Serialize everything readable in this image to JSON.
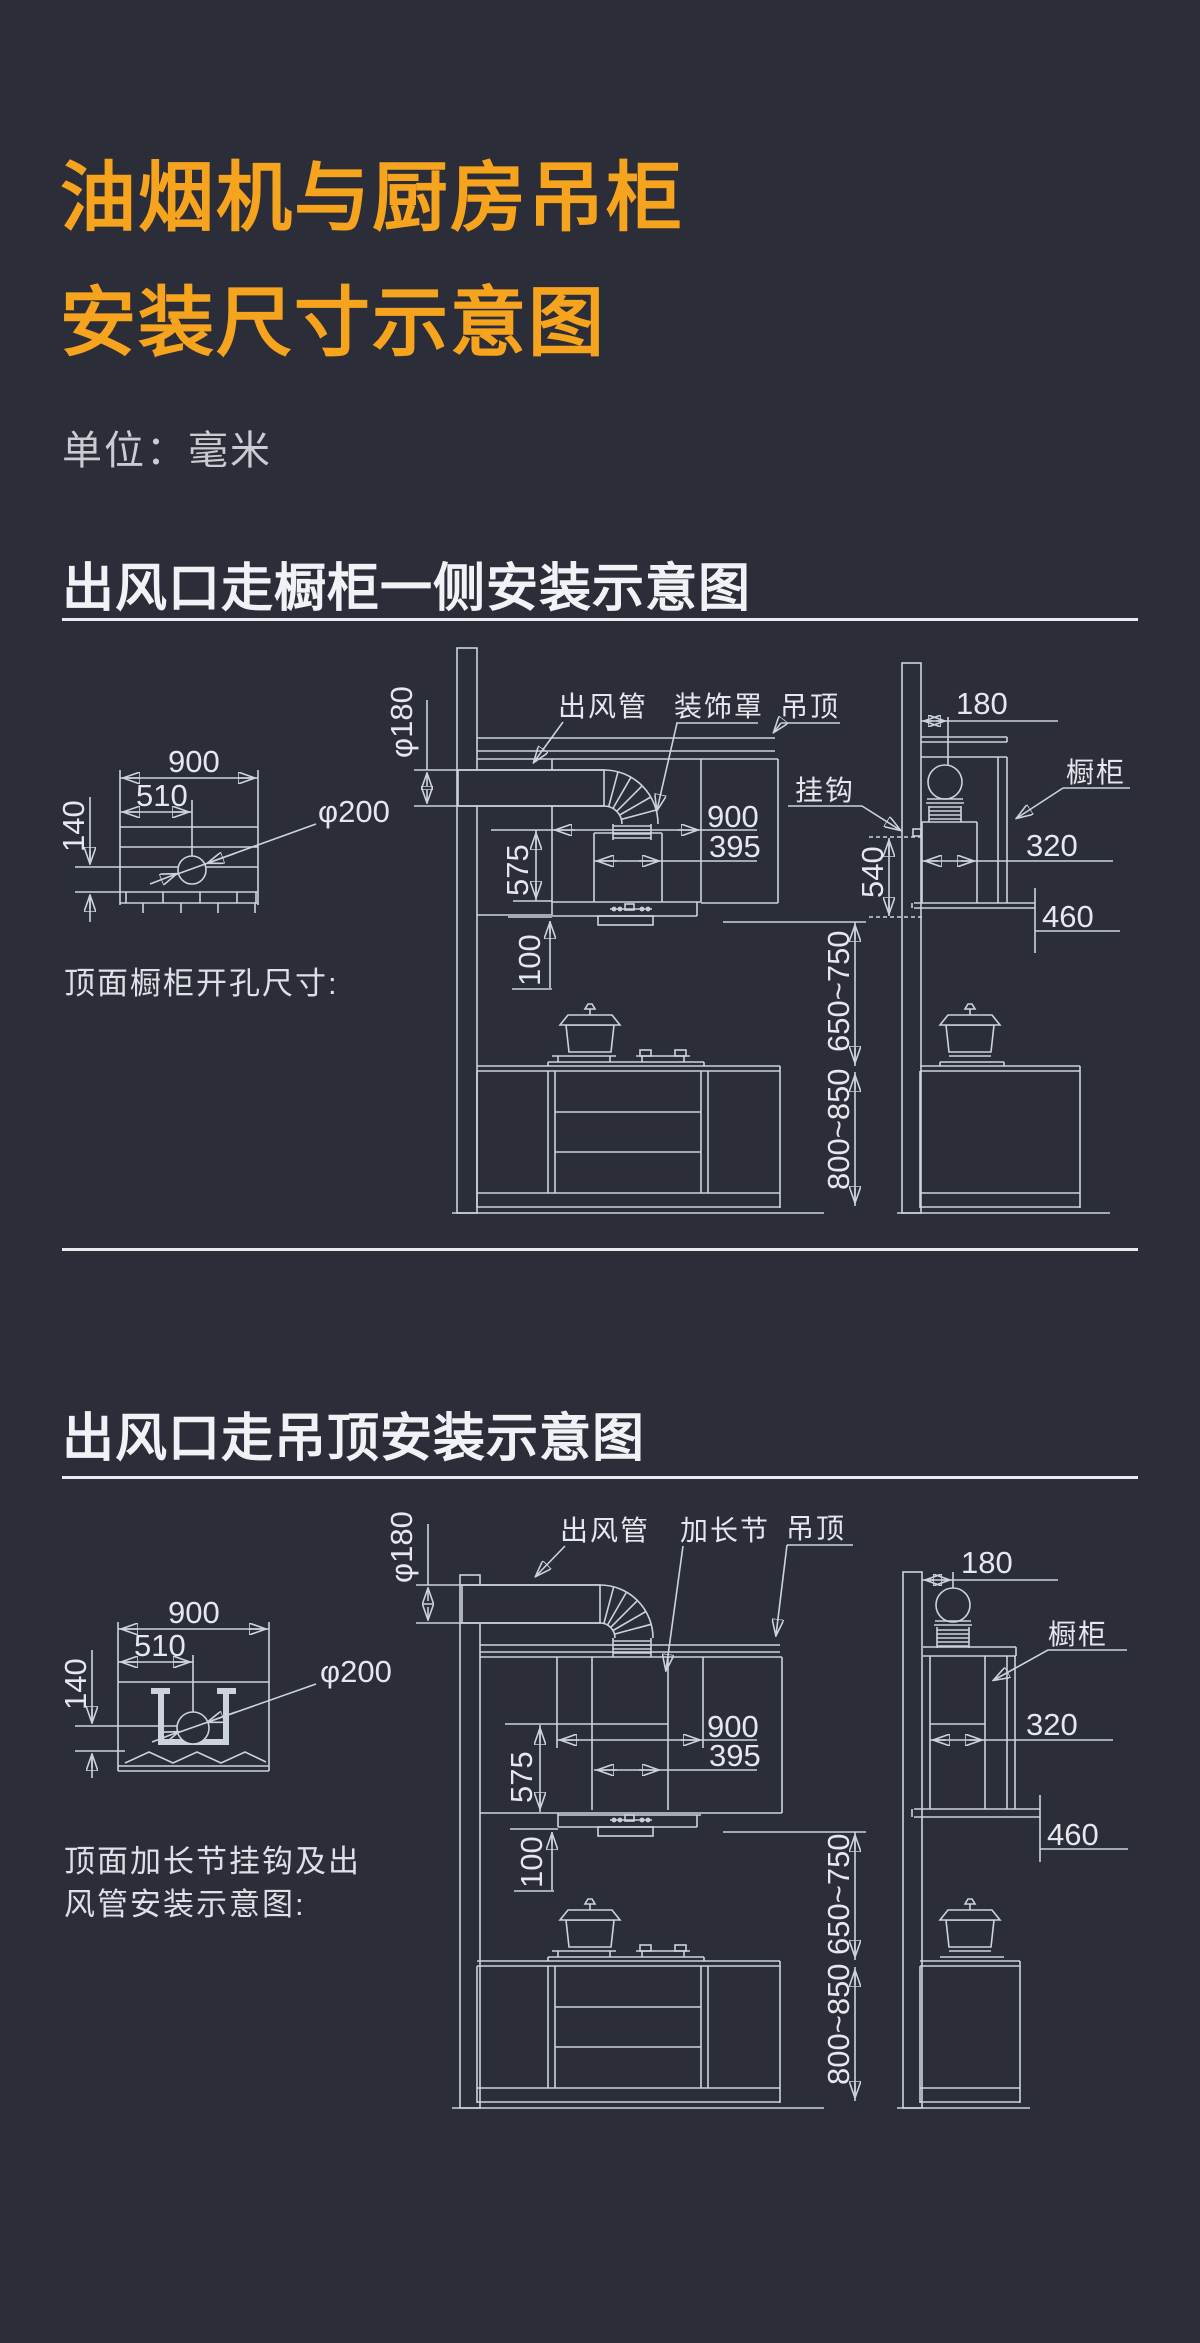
{
  "page": {
    "background": "#2b2d38",
    "accent_orange": "#f6a41d",
    "line_color": "#cdd3db",
    "text_color": "#e4e7ec"
  },
  "header": {
    "title_line1": "油烟机与厨房吊柜",
    "title_line2": "安装尺寸示意图",
    "unit_label": "单位：毫米"
  },
  "section1": {
    "heading": "出风口走橱柜一侧安装示意图",
    "note": "顶面橱柜开孔尺寸:",
    "labels": {
      "duct": "出风管",
      "cover": "装饰罩",
      "ceiling": "吊顶",
      "hook": "挂钩",
      "cabinet": "橱柜"
    },
    "dims": {
      "top_width": "900",
      "top_offset": "510",
      "top_depth": "140",
      "hole_dia": "φ200",
      "duct_dia": "φ180",
      "hood_width": "900",
      "body_width": "395",
      "hood_height": "575",
      "gap": "100",
      "hood_to_counter": "650~750",
      "counter_height": "800~850",
      "hook_height": "540",
      "wall_offset": "180",
      "side_depth": "320",
      "side_bottom": "460"
    }
  },
  "section2": {
    "heading": "出风口走吊顶安装示意图",
    "note_line1": "顶面加长节挂钩及出",
    "note_line2": "风管安装示意图:",
    "labels": {
      "duct": "出风管",
      "extension": "加长节",
      "ceiling": "吊顶",
      "cabinet": "橱柜"
    },
    "dims": {
      "top_width": "900",
      "top_offset": "510",
      "top_depth": "140",
      "hole_dia": "φ200",
      "duct_dia": "φ180",
      "hood_width": "900",
      "body_width": "395",
      "hood_height": "575",
      "gap": "100",
      "hood_to_counter": "650~750",
      "counter_height": "800~850",
      "wall_offset": "180",
      "side_depth": "320",
      "side_bottom": "460"
    }
  }
}
